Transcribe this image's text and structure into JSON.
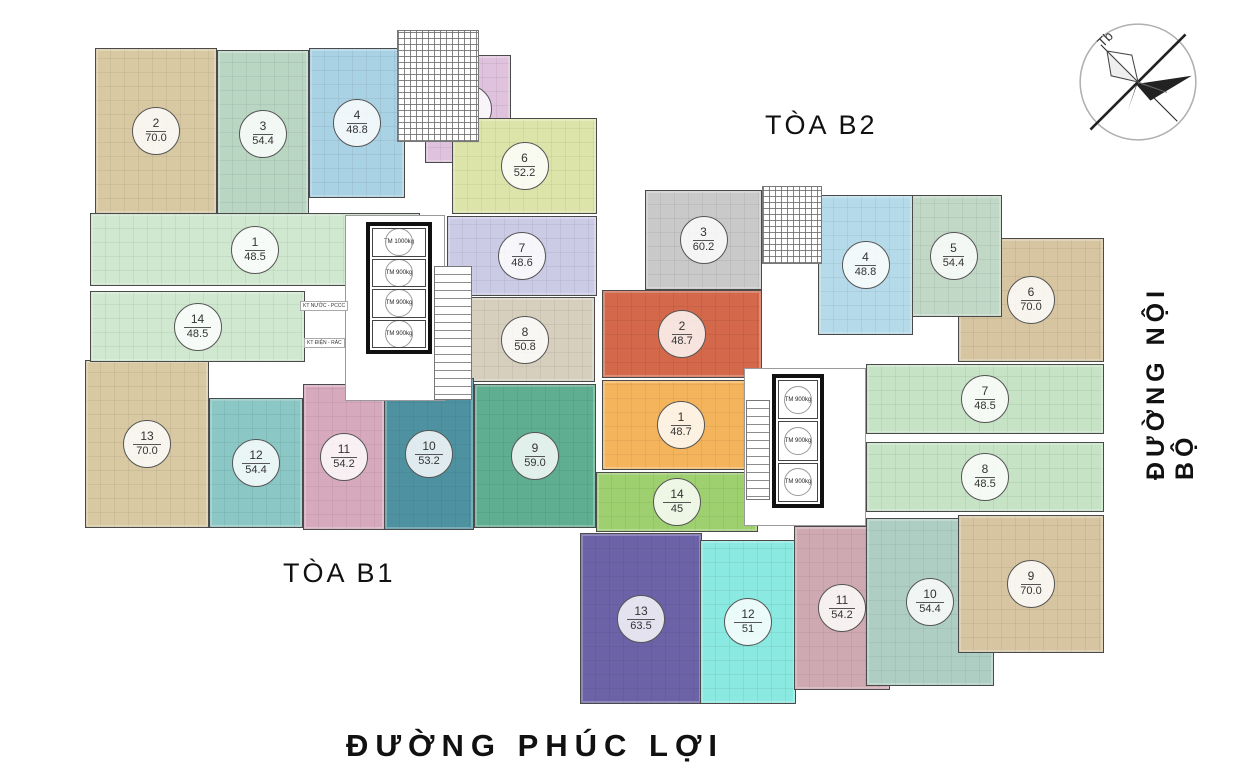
{
  "page": {
    "width": 1250,
    "height": 781,
    "background": "#ffffff"
  },
  "labels": {
    "building_b1": "TÒA B1",
    "building_b2": "TÒA B2",
    "road_right": "ĐƯỜNG NỘI BỘ",
    "road_bottom": "ĐƯỜNG PHÚC LỢI",
    "compass_letter": "Tb"
  },
  "buildings": [
    {
      "id": "b1",
      "name": "TÒA B1",
      "units": [
        {
          "no": "2",
          "area": "70.0",
          "color": "#d9c9a3",
          "x": 95,
          "y": 48,
          "w": 122,
          "h": 166
        },
        {
          "no": "3",
          "area": "54.4",
          "color": "#b9d6c3",
          "x": 217,
          "y": 50,
          "w": 92,
          "h": 168
        },
        {
          "no": "4",
          "area": "48.8",
          "color": "#a9d2e4",
          "x": 309,
          "y": 48,
          "w": 96,
          "h": 150
        },
        {
          "no": "5",
          "area": "50.6",
          "color": "#dfc2dd",
          "x": 425,
          "y": 55,
          "w": 86,
          "h": 108
        },
        {
          "no": "6",
          "area": "52.2",
          "color": "#dde4a9",
          "x": 452,
          "y": 118,
          "w": 145,
          "h": 96
        },
        {
          "no": "7",
          "area": "48.6",
          "color": "#cccbe6",
          "x": 447,
          "y": 216,
          "w": 150,
          "h": 80
        },
        {
          "no": "8",
          "area": "50.8",
          "color": "#d7cfbe",
          "x": 455,
          "y": 297,
          "w": 140,
          "h": 85
        },
        {
          "no": "9",
          "area": "59.0",
          "color": "#5fae92",
          "x": 474,
          "y": 384,
          "w": 122,
          "h": 144
        },
        {
          "no": "10",
          "area": "53.2",
          "color": "#4e92a2",
          "x": 384,
          "y": 378,
          "w": 90,
          "h": 152
        },
        {
          "no": "11",
          "area": "54.2",
          "color": "#d7a9bd",
          "x": 303,
          "y": 384,
          "w": 82,
          "h": 146
        },
        {
          "no": "12",
          "area": "54.4",
          "color": "#8ac7c5",
          "x": 209,
          "y": 398,
          "w": 94,
          "h": 130
        },
        {
          "no": "13",
          "area": "70.0",
          "color": "#d9c9a3",
          "x": 85,
          "y": 360,
          "w": 124,
          "h": 168
        },
        {
          "no": "14",
          "area": "48.5",
          "color": "#cfe8cf",
          "x": 90,
          "y": 291,
          "w": 215,
          "h": 71
        },
        {
          "no": "1",
          "area": "48.5",
          "color": "#cfe8cf",
          "x": 90,
          "y": 213,
          "w": 330,
          "h": 73
        }
      ],
      "core": {
        "x": 345,
        "y": 215,
        "w": 100,
        "h": 186
      },
      "frame": {
        "x": 366,
        "y": 222,
        "w": 66,
        "h": 132
      },
      "stair": {
        "x": 434,
        "y": 266,
        "w": 38,
        "h": 134
      },
      "hatch": {
        "x": 397,
        "y": 30,
        "w": 82,
        "h": 112
      },
      "elevators": [
        "TM 1000kg",
        "TM 900kg",
        "TM 900kg",
        "TM 900kg"
      ],
      "tech_labels": [
        {
          "text": "KT NƯỚC - PCCC",
          "x": 300,
          "y": 301
        },
        {
          "text": "KT ĐIỆN - RÁC",
          "x": 304,
          "y": 338
        }
      ]
    },
    {
      "id": "b2",
      "name": "TÒA B2",
      "units": [
        {
          "no": "6",
          "area": "70.0",
          "color": "#d6c5a0",
          "x": 958,
          "y": 238,
          "w": 146,
          "h": 124
        },
        {
          "no": "5",
          "area": "54.4",
          "color": "#c2d8c7",
          "x": 905,
          "y": 195,
          "w": 97,
          "h": 122
        },
        {
          "no": "4",
          "area": "48.8",
          "color": "#b5dbea",
          "x": 818,
          "y": 195,
          "w": 95,
          "h": 140
        },
        {
          "no": "3",
          "area": "60.2",
          "color": "#c9c9c9",
          "x": 645,
          "y": 190,
          "w": 117,
          "h": 100
        },
        {
          "no": "2",
          "area": "48.7",
          "color": "#d4684a",
          "x": 602,
          "y": 290,
          "w": 160,
          "h": 88
        },
        {
          "no": "1",
          "area": "48.7",
          "color": "#f4b45c",
          "x": 602,
          "y": 380,
          "w": 158,
          "h": 90
        },
        {
          "no": "14",
          "area": "45",
          "color": "#9ed06f",
          "x": 596,
          "y": 472,
          "w": 162,
          "h": 60
        },
        {
          "no": "13",
          "area": "63.5",
          "color": "#6b62a7",
          "x": 580,
          "y": 533,
          "w": 122,
          "h": 171
        },
        {
          "no": "12",
          "area": "51",
          "color": "#8ae9e0",
          "x": 700,
          "y": 540,
          "w": 96,
          "h": 164
        },
        {
          "no": "11",
          "area": "54.2",
          "color": "#cfa9b1",
          "x": 794,
          "y": 526,
          "w": 96,
          "h": 164
        },
        {
          "no": "10",
          "area": "54.4",
          "color": "#afcec3",
          "x": 866,
          "y": 518,
          "w": 128,
          "h": 168
        },
        {
          "no": "9",
          "area": "70.0",
          "color": "#d6c5a0",
          "x": 958,
          "y": 515,
          "w": 146,
          "h": 138
        },
        {
          "no": "8",
          "area": "48.5",
          "color": "#c6e3c6",
          "x": 866,
          "y": 442,
          "w": 238,
          "h": 70
        },
        {
          "no": "7",
          "area": "48.5",
          "color": "#c6e3c6",
          "x": 866,
          "y": 364,
          "w": 238,
          "h": 70
        }
      ],
      "core": {
        "x": 744,
        "y": 368,
        "w": 122,
        "h": 158
      },
      "frame": {
        "x": 772,
        "y": 374,
        "w": 52,
        "h": 134
      },
      "stair": {
        "x": 746,
        "y": 400,
        "w": 24,
        "h": 100
      },
      "hatch": {
        "x": 762,
        "y": 186,
        "w": 60,
        "h": 78
      },
      "elevators": [
        "TM 900kg",
        "TM 900kg",
        "TM 900kg"
      ],
      "tech_labels": []
    }
  ]
}
